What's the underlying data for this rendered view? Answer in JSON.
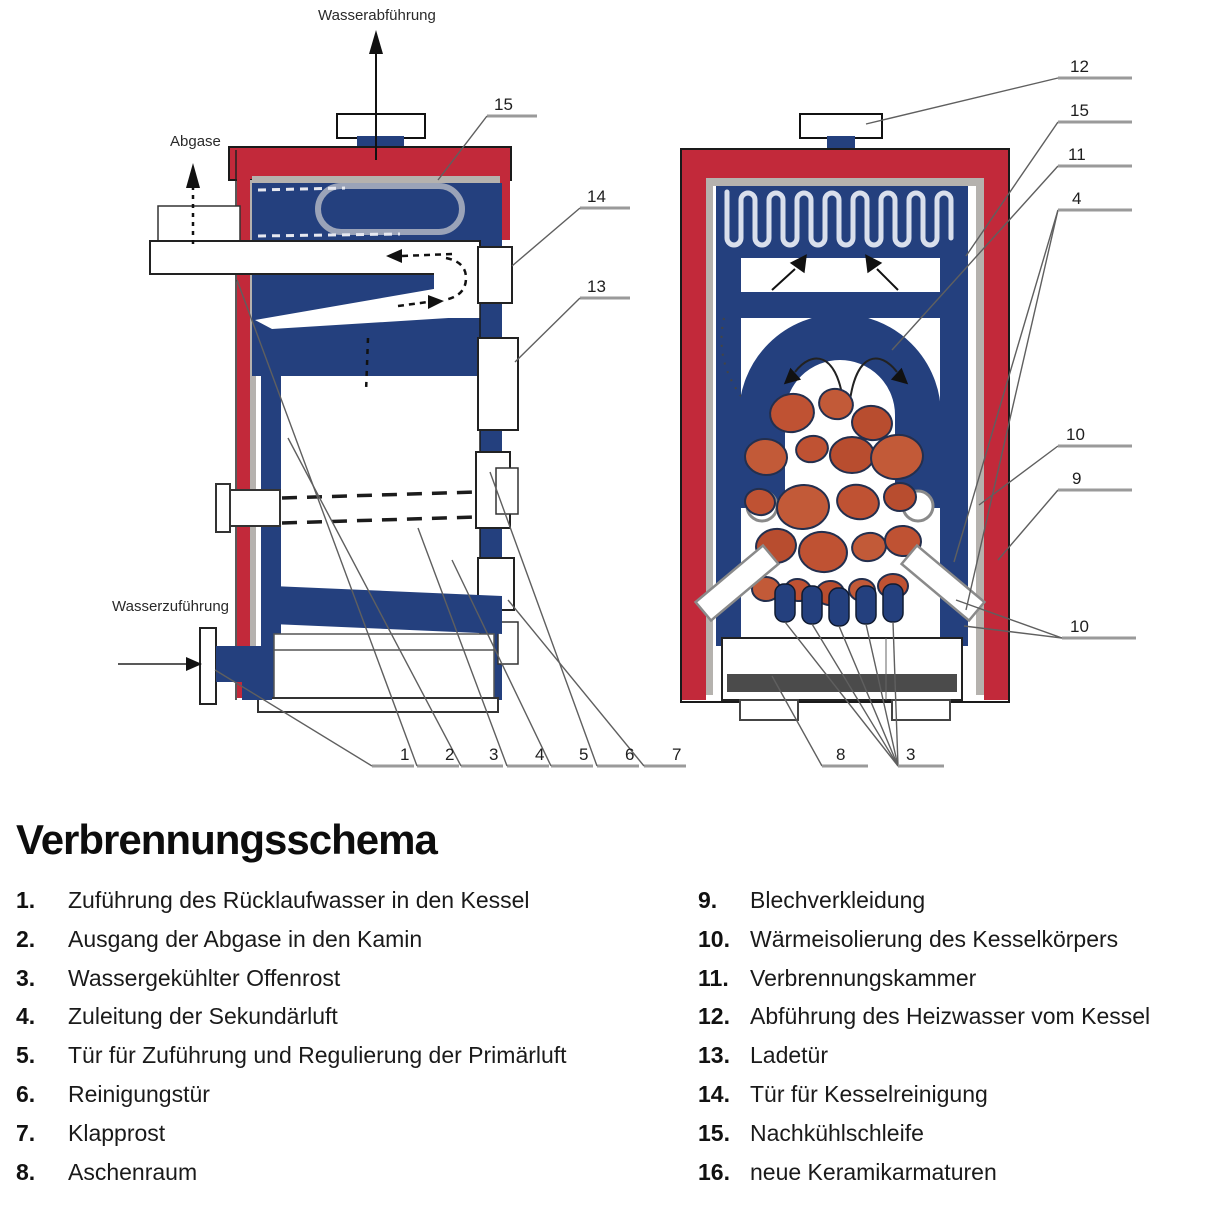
{
  "title": "Verbrennungsschema",
  "colors": {
    "boiler_red": "#c2293a",
    "water_blue": "#24407e",
    "coal_orange": "#bf5233",
    "insulation_gray": "#b5b2ae"
  },
  "diagram": {
    "labels": {
      "water_out": "Wasserabführung",
      "exhaust": "Abgase",
      "water_in": "Wasserzuführung"
    },
    "left": {
      "side": [
        "15",
        "14",
        "13"
      ],
      "bottom": [
        "1",
        "2",
        "3",
        "4",
        "5",
        "6",
        "7"
      ]
    },
    "right": {
      "side": [
        "12",
        "15",
        "11",
        "4",
        "10",
        "9",
        "10"
      ],
      "bottom": [
        "8",
        "3"
      ]
    }
  },
  "legend": {
    "left": [
      {
        "num": "1.",
        "text": "Zuführung des Rücklaufwasser in den Kessel"
      },
      {
        "num": "2.",
        "text": "Ausgang der Abgase in den Kamin"
      },
      {
        "num": "3.",
        "text": "Wassergekühlter Offenrost"
      },
      {
        "num": "4.",
        "text": "Zuleitung der Sekundärluft"
      },
      {
        "num": "5.",
        "text": "Tür für Zuführung und Regulierung der Primärluft"
      },
      {
        "num": "6.",
        "text": "Reinigungstür"
      },
      {
        "num": "7.",
        "text": "Klapprost"
      },
      {
        "num": "8.",
        "text": "Aschenraum"
      }
    ],
    "right": [
      {
        "num": "9.",
        "text": "Blechverkleidung"
      },
      {
        "num": "10.",
        "text": "Wärmeisolierung des Kesselkörpers"
      },
      {
        "num": "11.",
        "text": "Verbrennungskammer"
      },
      {
        "num": "12.",
        "text": "Abführung des Heizwasser vom Kessel"
      },
      {
        "num": "13.",
        "text": "Ladetür"
      },
      {
        "num": "14.",
        "text": "Tür für Kesselreinigung"
      },
      {
        "num": "15.",
        "text": "Nachkühlschleife"
      },
      {
        "num": "16.",
        "text": "neue Keramikarmaturen"
      }
    ]
  }
}
